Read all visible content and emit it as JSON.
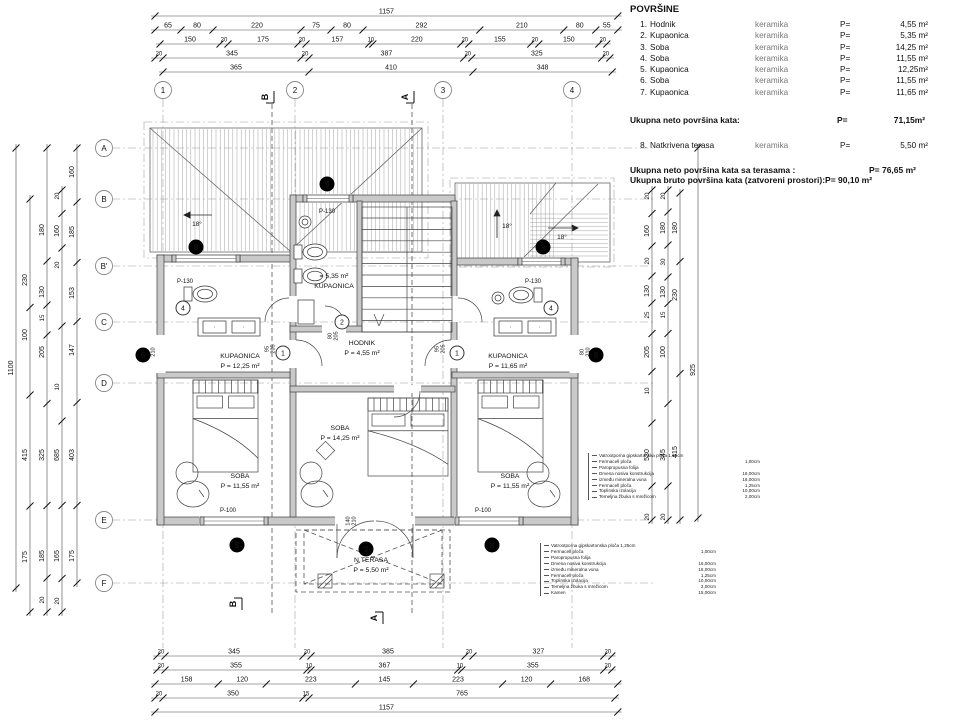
{
  "legend": {
    "title": "POVRŠINE",
    "rows": [
      {
        "num": "1.",
        "name": "Hodnik",
        "material": "keramika",
        "p": "P=",
        "value": "4,55 m²"
      },
      {
        "num": "2.",
        "name": "Kupaonica",
        "material": "keramika",
        "p": "P=",
        "value": "5,35 m²"
      },
      {
        "num": "3.",
        "name": "Soba",
        "material": "keramika",
        "p": "P=",
        "value": "14,25 m²"
      },
      {
        "num": "4.",
        "name": "Soba",
        "material": "keramika",
        "p": "P=",
        "value": "11,55 m²"
      },
      {
        "num": "5.",
        "name": "Kupaonica",
        "material": "keramika",
        "p": "P=",
        "value": "12,25m²"
      },
      {
        "num": "6.",
        "name": "Soba",
        "material": "keramika",
        "p": "P=",
        "value": "11,55 m²"
      },
      {
        "num": "7.",
        "name": "Kupaonica",
        "material": "keramika",
        "p": "P=",
        "value": "11,65 m²"
      }
    ],
    "subtotal": {
      "label": "Ukupna neto površina kata:",
      "p": "P=",
      "value": "71,15m²"
    },
    "terrace": {
      "num": "8.",
      "name": "Natkrivena terasa",
      "material": "keramika",
      "p": "P=",
      "value": "5,50 m²"
    },
    "total_net": {
      "label": "Ukupna neto površina kata sa terasama :",
      "value": "P= 76,65 m²"
    },
    "total_gross": {
      "label": "Ukupna bruto površina kata (zatvoreni prostori):",
      "value": "P= 90,10 m²"
    }
  },
  "grid": {
    "cols": [
      {
        "label": "1",
        "x": 163
      },
      {
        "label": "2",
        "x": 295
      },
      {
        "label": "3",
        "x": 443
      },
      {
        "label": "4",
        "x": 572
      }
    ],
    "col_y": 90,
    "rows": [
      {
        "label": "A",
        "y": 148
      },
      {
        "label": "B",
        "y": 199
      },
      {
        "label": "B'",
        "y": 266
      },
      {
        "label": "C",
        "y": 322
      },
      {
        "label": "D",
        "y": 383
      },
      {
        "label": "E",
        "y": 520
      },
      {
        "label": "F",
        "y": 583
      }
    ],
    "row_x": 104
  },
  "sections": [
    {
      "label": "B",
      "x": 268,
      "y": 97,
      "pos": "top"
    },
    {
      "label": "A",
      "x": 408,
      "y": 97,
      "pos": "top"
    },
    {
      "label": "B",
      "x": 236,
      "y": 604,
      "pos": "bottom"
    },
    {
      "label": "A",
      "x": 377,
      "y": 618,
      "pos": "bottom"
    }
  ],
  "dimensions": {
    "scale": 0.4,
    "top_rows": [
      {
        "y": 16,
        "x1": 155,
        "vals": [
          "1157"
        ]
      },
      {
        "y": 30,
        "x1": 155,
        "vals": [
          "65",
          "80",
          "220",
          "75",
          "80",
          "292",
          "210",
          "80",
          "55"
        ]
      },
      {
        "y": 44,
        "x1": 160,
        "vals": [
          "150",
          "20",
          "175",
          "20",
          "157",
          "10",
          "220",
          "20",
          "155",
          "20",
          "150",
          "20"
        ]
      },
      {
        "y": 58,
        "x1": 155,
        "vals": [
          "20",
          "345",
          "20",
          "387",
          "20",
          "325",
          "20"
        ]
      },
      {
        "y": 72,
        "x1": 163,
        "vals": [
          "365",
          "410",
          "348"
        ]
      }
    ],
    "bottom_rows": [
      {
        "y": 656,
        "x1": 157,
        "vals": [
          "20",
          "345",
          "20",
          "385",
          "20",
          "327",
          "20"
        ]
      },
      {
        "y": 670,
        "x1": 157,
        "vals": [
          "20",
          "355",
          "10",
          "367",
          "10",
          "355",
          "20"
        ]
      },
      {
        "y": 684,
        "x1": 155,
        "vals": [
          "158",
          "120",
          "223",
          "145",
          "223",
          "120",
          "168"
        ]
      },
      {
        "y": 698,
        "x1": 155,
        "vals": [
          "20",
          "350",
          "15",
          "765"
        ]
      },
      {
        "y": 712,
        "x1": 155,
        "vals": [
          "1157"
        ]
      }
    ],
    "left_cols": [
      {
        "x": 16,
        "y1": 148,
        "y2": 588,
        "labels": [
          [
            "1100",
            368
          ]
        ]
      },
      {
        "x": 30,
        "y1": 199,
        "y2": 612,
        "labels": [
          [
            "230",
            280
          ],
          [
            "100",
            335
          ],
          [
            "415",
            455
          ],
          [
            "175",
            557
          ]
        ]
      },
      {
        "x": 47,
        "y1": 148,
        "y2": 612,
        "labels": [
          [
            "180",
            230
          ],
          [
            "130",
            292
          ],
          [
            "15",
            318
          ],
          [
            "205",
            352
          ],
          [
            "325",
            455
          ],
          [
            "185",
            556
          ],
          [
            "20",
            600
          ]
        ]
      },
      {
        "x": 62,
        "y1": 190,
        "y2": 612,
        "labels": [
          [
            "20",
            196
          ],
          [
            "160",
            231
          ],
          [
            "20",
            265
          ],
          [
            "10",
            387
          ],
          [
            "685",
            455
          ],
          [
            "165",
            556
          ],
          [
            "20",
            601
          ]
        ]
      },
      {
        "x": 77,
        "y1": 148,
        "y2": 583,
        "labels": [
          [
            "160",
            172
          ],
          [
            "185",
            232
          ],
          [
            "153",
            293
          ],
          [
            "147",
            350
          ],
          [
            "403",
            455
          ],
          [
            "175",
            556
          ]
        ]
      }
    ],
    "right_cols": [
      {
        "x": 652,
        "y1": 190,
        "y2": 520,
        "labels": [
          [
            "20",
            196
          ],
          [
            "160",
            231
          ],
          [
            "20",
            261
          ],
          [
            "130",
            291
          ],
          [
            "25",
            315
          ],
          [
            "205",
            352
          ],
          [
            "10",
            391
          ],
          [
            "530",
            455
          ],
          [
            "20",
            517
          ]
        ]
      },
      {
        "x": 668,
        "y1": 190,
        "y2": 520,
        "labels": [
          [
            "20",
            196
          ],
          [
            "180",
            228
          ],
          [
            "30",
            262
          ],
          [
            "130",
            292
          ],
          [
            "15",
            315
          ],
          [
            "100",
            352
          ],
          [
            "345",
            455
          ],
          [
            "20",
            517
          ]
        ]
      },
      {
        "x": 680,
        "y1": 193,
        "y2": 520,
        "labels": [
          [
            "180",
            228
          ],
          [
            "230",
            295
          ],
          [
            "415",
            452
          ]
        ]
      },
      {
        "x": 698,
        "y1": 148,
        "y2": 518,
        "labels": [
          [
            "925",
            370
          ]
        ]
      }
    ]
  },
  "rooms": [
    {
      "lines": [
        "KUPAONICA",
        "P = 12,25 m²"
      ],
      "x": 240,
      "y": 358
    },
    {
      "lines": [
        "= 5,35 m²",
        "KUPAONICA"
      ],
      "x": 334,
      "y": 278
    },
    {
      "lines": [
        "KUPAONICA",
        "P = 11,65 m²"
      ],
      "x": 508,
      "y": 358
    },
    {
      "lines": [
        "HODNIK",
        "P = 4,55 m²"
      ],
      "x": 362,
      "y": 345
    },
    {
      "lines": [
        "SOBA",
        "P = 11,55 m²"
      ],
      "x": 240,
      "y": 478
    },
    {
      "lines": [
        "SOBA",
        "P = 14,25 m²"
      ],
      "x": 340,
      "y": 430
    },
    {
      "lines": [
        "SOBA",
        "P = 11,55 m²"
      ],
      "x": 510,
      "y": 478
    },
    {
      "lines": [
        "N.TERASA",
        "P = 5,50 m²"
      ],
      "x": 371,
      "y": 562
    }
  ],
  "window_labels": [
    {
      "text": "P-130",
      "x": 185,
      "y": 283
    },
    {
      "text": "P-130",
      "x": 327,
      "y": 213
    },
    {
      "text": "P-130",
      "x": 533,
      "y": 283
    },
    {
      "text": "P-100",
      "x": 228,
      "y": 512
    },
    {
      "text": "P-100",
      "x": 483,
      "y": 512
    }
  ],
  "position_markers": [
    {
      "n": "9",
      "x": 196,
      "y": 247
    },
    {
      "n": "9",
      "x": 327,
      "y": 184
    },
    {
      "n": "9",
      "x": 543,
      "y": 247
    },
    {
      "n": "6",
      "x": 143,
      "y": 355
    },
    {
      "n": "6",
      "x": 596,
      "y": 355
    },
    {
      "n": "8",
      "x": 237,
      "y": 545
    },
    {
      "n": "8",
      "x": 492,
      "y": 545
    },
    {
      "n": "3",
      "x": 366,
      "y": 549
    }
  ],
  "door_markers": [
    {
      "n": "1",
      "x": 283,
      "y": 353
    },
    {
      "n": "1",
      "x": 457,
      "y": 353
    },
    {
      "n": "2",
      "x": 342,
      "y": 322
    },
    {
      "n": "4",
      "x": 183,
      "y": 308
    },
    {
      "n": "4",
      "x": 551,
      "y": 308
    }
  ],
  "small_dims": [
    {
      "a": "95",
      "b": "205",
      "x": 271,
      "y": 349
    },
    {
      "a": "95",
      "b": "205",
      "x": 441,
      "y": 349
    },
    {
      "a": "80",
      "b": "205",
      "x": 334,
      "y": 336
    },
    {
      "a": "80",
      "b": "210",
      "x": 151,
      "y": 352
    },
    {
      "a": "80",
      "b": "210",
      "x": 586,
      "y": 352
    },
    {
      "a": "140",
      "b": "210",
      "x": 352,
      "y": 521
    }
  ],
  "roof_labels": [
    {
      "text": "18°",
      "x": 197,
      "y": 226,
      "dir": "left"
    },
    {
      "text": "18°",
      "x": 507,
      "y": 228,
      "dir": "up"
    },
    {
      "text": "18°",
      "x": 562,
      "y": 239,
      "dir": "right"
    }
  ],
  "notes_upper": {
    "rows": [
      {
        "label": "Vatrootporna gipskartonska ploča 1,25cm",
        "value": ""
      },
      {
        "label": "Fermacell ploča",
        "value": "1,00cm"
      },
      {
        "label": "Paropropusna folija",
        "value": ""
      },
      {
        "label": "Drvena nosiva konstrukcija",
        "value": "16,00cm"
      },
      {
        "label": "između mineralna vuna",
        "value": "16,00cm"
      },
      {
        "label": "Fermacell ploča",
        "value": "1,25cm"
      },
      {
        "label": "Toplinska izolacija",
        "value": "10,00cm"
      },
      {
        "label": "Temeljna žbuka s mrežicom",
        "value": "2,00cm"
      }
    ]
  },
  "notes_lower": {
    "rows": [
      {
        "label": "Vatrootporna gipskartonska ploča 1,25cm",
        "value": ""
      },
      {
        "label": "Fermacell ploča",
        "value": "1,00cm"
      },
      {
        "label": "Paropropusna folija",
        "value": ""
      },
      {
        "label": "Drvena nosiva konstrukcija",
        "value": "16,00cm"
      },
      {
        "label": "između mineralna vuna",
        "value": "16,00cm"
      },
      {
        "label": "Fermacell ploča",
        "value": "1,25cm"
      },
      {
        "label": "Toplinska izolacija",
        "value": "10,00cm"
      },
      {
        "label": "Temeljna žbuka s mrežicom",
        "value": "2,00cm"
      },
      {
        "label": "Kamen",
        "value": "15,00cm"
      }
    ]
  }
}
